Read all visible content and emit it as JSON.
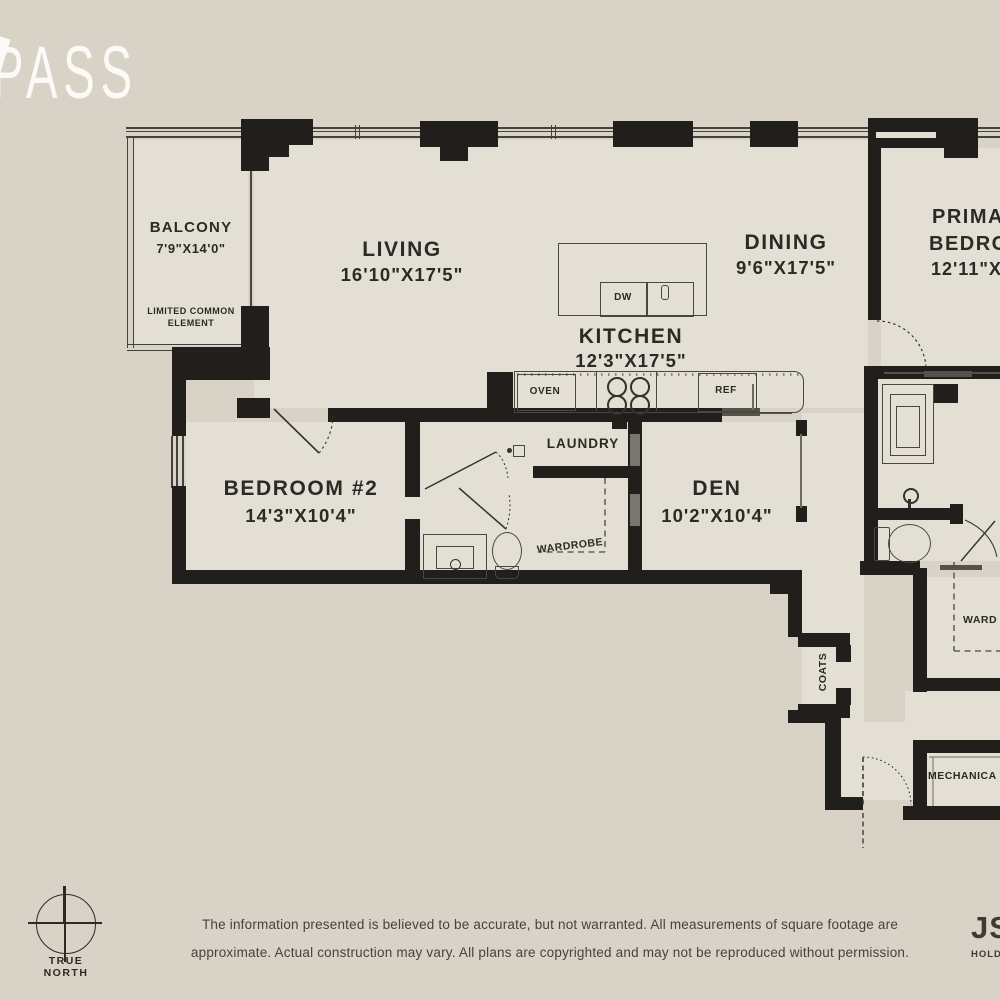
{
  "brand": {
    "logo_text": "PASS"
  },
  "plan": {
    "rooms": {
      "balcony": {
        "name": "BALCONY",
        "dims": "7'9\"X14'0\"",
        "note1": "LIMITED COMMON",
        "note2": "ELEMENT"
      },
      "living": {
        "name": "LIVING",
        "dims": "16'10\"X17'5\""
      },
      "dining": {
        "name": "DINING",
        "dims": "9'6\"X17'5\""
      },
      "kitchen": {
        "name": "KITCHEN",
        "dims": "12'3\"X17'5\""
      },
      "primary_bedroom": {
        "name1": "PRIMA",
        "name2": "BEDRO",
        "dims": "12'11\"X1"
      },
      "bedroom2": {
        "name": "BEDROOM #2",
        "dims": "14'3\"X10'4\""
      },
      "den": {
        "name": "DEN",
        "dims": "10'2\"X10'4\""
      },
      "laundry": {
        "name": "LAUNDRY"
      },
      "wardrobe": {
        "name": "WARDROBE"
      },
      "wardrobe_primary": {
        "name": "WARD"
      },
      "coats": {
        "name": "COATS"
      },
      "mechanical": {
        "name": "MECHANICA"
      }
    },
    "appliances": {
      "dishwasher": "DW",
      "oven": "OVEN",
      "fridge": "REF"
    }
  },
  "compass_rose": {
    "label1": "TRUE",
    "label2": "NORTH"
  },
  "disclaimer": {
    "line1": "The information presented is believed to be accurate, but not warranted. All measurements of square footage are",
    "line2": "approximate. Actual construction may vary. All plans are copyrighted and may not be reproduced without permission."
  },
  "developer_logo": {
    "line1": "JS",
    "line2": "HOLD"
  },
  "colors": {
    "background": "#d8d2c7",
    "floor": "#e4dfd4",
    "wall": "#211f1c",
    "accent_gray": "#55524b",
    "text": "#2b2a26",
    "logo": "#fbfaf6"
  }
}
